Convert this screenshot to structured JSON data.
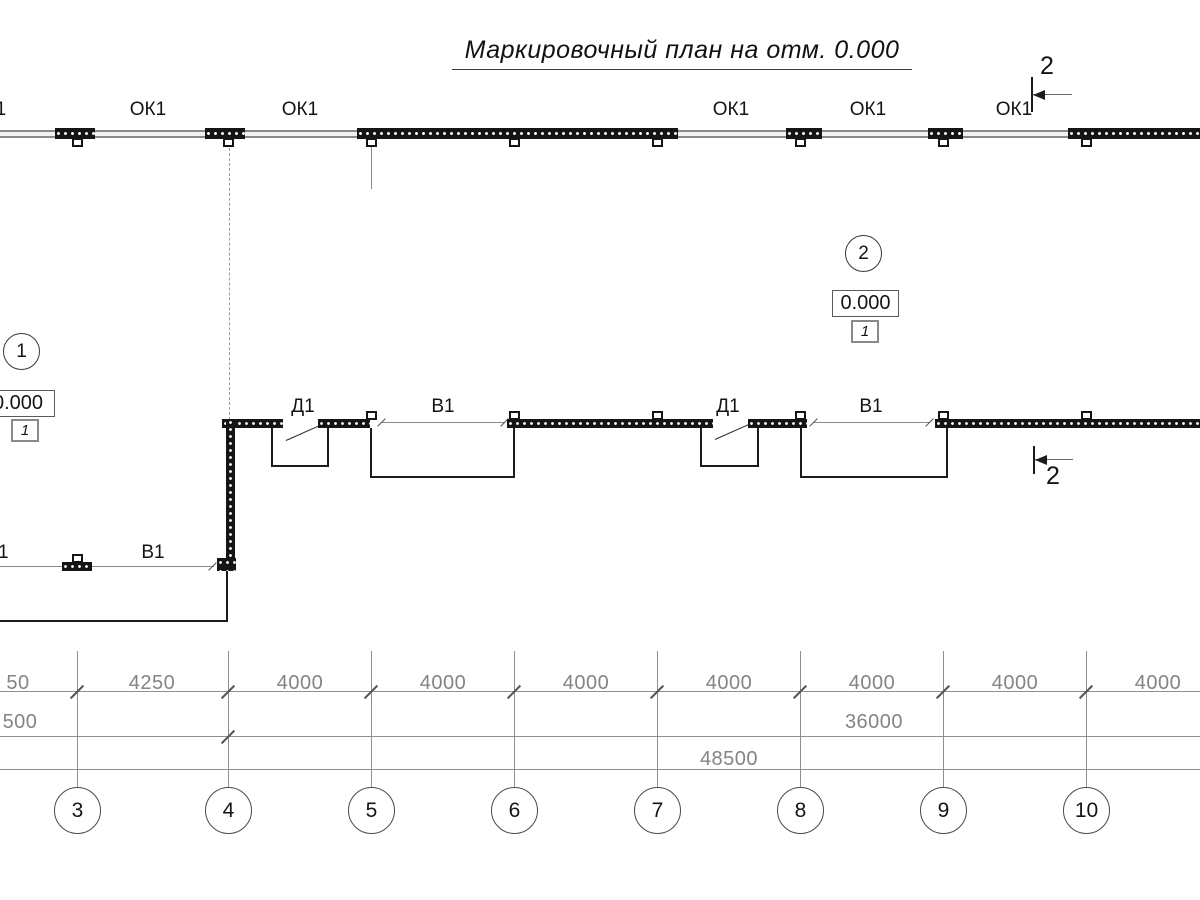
{
  "title": "Маркировочный план на отм. 0.000",
  "marks": {
    "window": "ОК1",
    "door": "Д1",
    "gate": "В1",
    "section": "2",
    "node1": "1",
    "node2": "2",
    "elevation": "0.000",
    "detail": "1"
  },
  "dimensions": {
    "row1": [
      "50",
      "4250",
      "4000",
      "4000",
      "4000",
      "4000",
      "4000",
      "4000",
      "4000"
    ],
    "row2": [
      "500",
      "36000"
    ],
    "row3": [
      "48500"
    ],
    "axes": [
      "3",
      "4",
      "5",
      "6",
      "7",
      "8",
      "9",
      "10"
    ]
  },
  "colors": {
    "line": "#1a1a1a",
    "dim": "#848484"
  }
}
